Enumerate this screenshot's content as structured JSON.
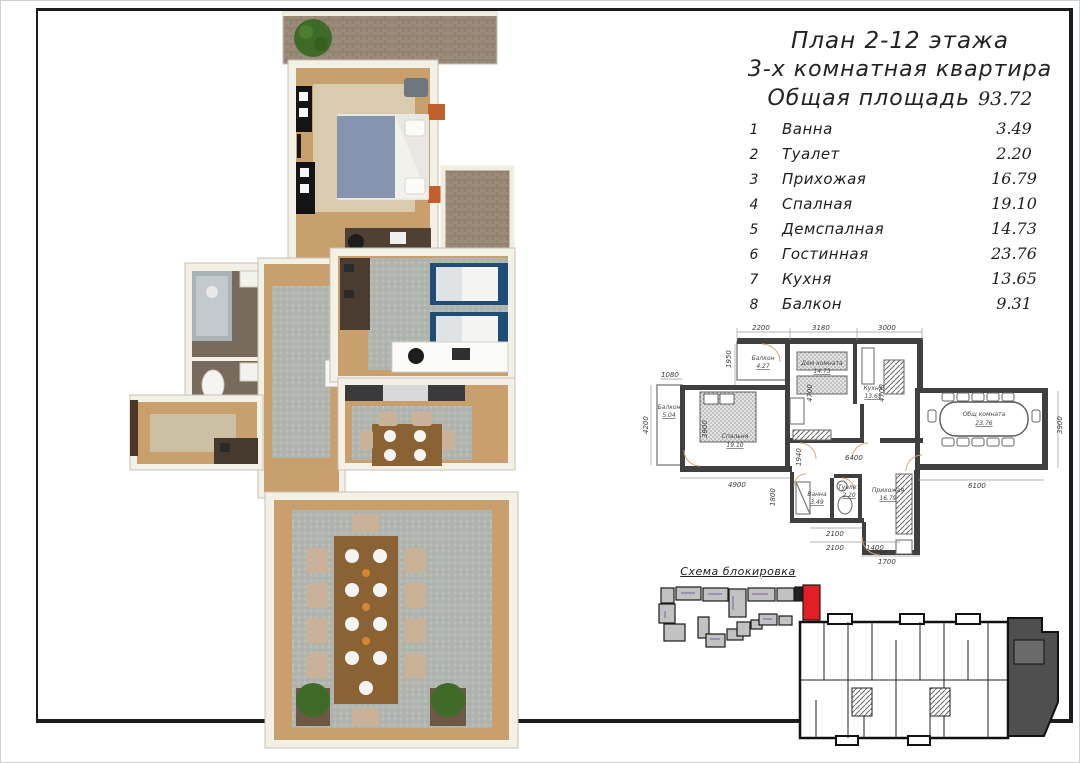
{
  "header": {
    "title_line1": "План 2-12 этажа",
    "title_line2": "3-х комнатная квартира",
    "total_area_label": "Общая площадь",
    "total_area_value": "93.72"
  },
  "rooms": [
    {
      "num": "1",
      "name": "Ванна",
      "area": "3.49"
    },
    {
      "num": "2",
      "name": "Туалет",
      "area": "2.20"
    },
    {
      "num": "3",
      "name": "Прихожая",
      "area": "16.79"
    },
    {
      "num": "4",
      "name": "Спалная",
      "area": "19.10"
    },
    {
      "num": "5",
      "name": "Демспалная",
      "area": "14.73"
    },
    {
      "num": "6",
      "name": "Гостинная",
      "area": "23.76"
    },
    {
      "num": "7",
      "name": "Кухня",
      "area": "13.65"
    },
    {
      "num": "8",
      "name": "Балкон",
      "area": "9.31"
    }
  ],
  "plan2d": {
    "rooms": [
      {
        "name": "Балкон",
        "area": "4.27"
      },
      {
        "name": "Дем комната",
        "area": "14.73"
      },
      {
        "name": "Кухня",
        "area": "13.65"
      },
      {
        "name": "Спальня",
        "area": "19.10"
      },
      {
        "name": "Балкон",
        "area": "5.04"
      },
      {
        "name": "Общ комната",
        "area": "23.76"
      },
      {
        "name": "Ванна",
        "area": "3.49"
      },
      {
        "name": "Туалет",
        "area": "2.20"
      },
      {
        "name": "Прихожая",
        "area": "16.79"
      }
    ],
    "dims": {
      "top": [
        "2200",
        "3180",
        "3000"
      ],
      "left": [
        "1080",
        "1950",
        "4200"
      ],
      "inner": [
        "3900",
        "4700",
        "4700",
        "6400",
        "1940",
        "1800"
      ],
      "bottom": [
        "4900",
        "2100",
        "2100",
        "1400",
        "1700",
        "6100"
      ],
      "right": [
        "3900"
      ]
    }
  },
  "scheme": {
    "label": "Схема блокировка",
    "highlight_color": "#e31e24",
    "block_color": "#c2c2c2"
  },
  "colors": {
    "wall_cad": "#3f3f3f",
    "floor_wood": "#c99f6e",
    "building_highlight": "#4f4f4f"
  }
}
